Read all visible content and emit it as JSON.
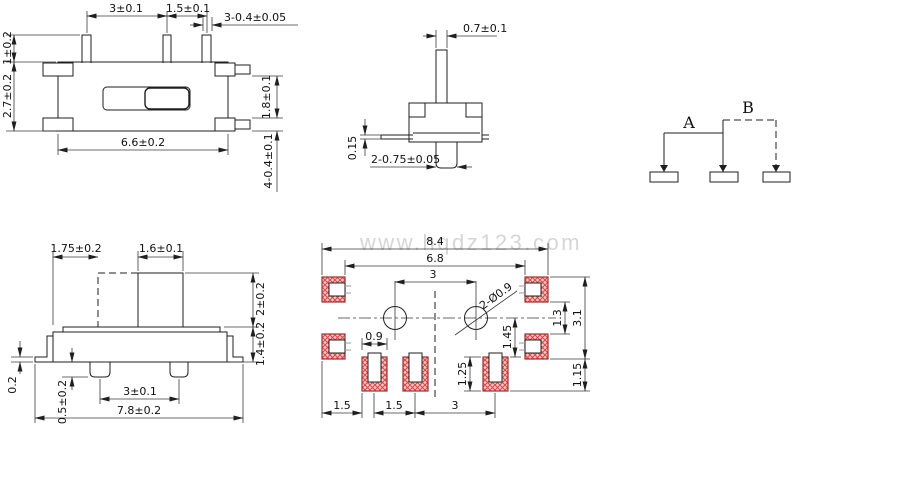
{
  "watermark": "www.hqdz123.com",
  "colors": {
    "line": "#1f1f1f",
    "pad_fill": "#f8c8c8",
    "pad_hatch_line": "#d94b4b",
    "pad_border": "#99302e",
    "watermark": "#d6d6d6"
  },
  "views": {
    "top": {
      "dim_pin_pitch_a": "3±0.1",
      "dim_pin_pitch_b": "1.5±0.1",
      "dim_pin_width": "3-0.4±0.05",
      "dim_pin_length": "1±0.2",
      "dim_body_depth": "2.7±0.2",
      "dim_tab_gap": "1.8±0.1",
      "dim_tab_thickness": "4-0.4±0.1",
      "dim_body_width": "6.6±0.2"
    },
    "side": {
      "dim_stem_width": "0.7±0.1",
      "dim_lead_thickness": "0.15",
      "dim_foot_width": "2-0.75±0.05"
    },
    "schematic": {
      "label_a": "A",
      "label_b": "B"
    },
    "front": {
      "dim_travel": "1.75±0.2",
      "dim_knob_width": "1.6±0.1",
      "dim_knob_height": "2±0.2",
      "dim_body_height": "1.4±0.2",
      "dim_flange_thickness": "0.2",
      "dim_foot_height": "0.5±0.2",
      "dim_foot_pitch": "3±0.1",
      "dim_overall_width": "7.8±0.2"
    },
    "pcb": {
      "dim_overall_width": "8.4",
      "dim_pad_span": "6.8",
      "dim_hole_pitch": "3",
      "dim_hole_callout": "2-Ø0.9",
      "dim_corner_gap": "1.3",
      "dim_overall_height": "3.1",
      "dim_center_to_pad": "1.45",
      "dim_pad_height": "1.25",
      "dim_bottom_offset": "1.15",
      "dim_pad_width": "0.9",
      "dim_left_gap": "1.5",
      "dim_pad_gap": "1.5",
      "dim_pad_pitch": "3"
    }
  }
}
